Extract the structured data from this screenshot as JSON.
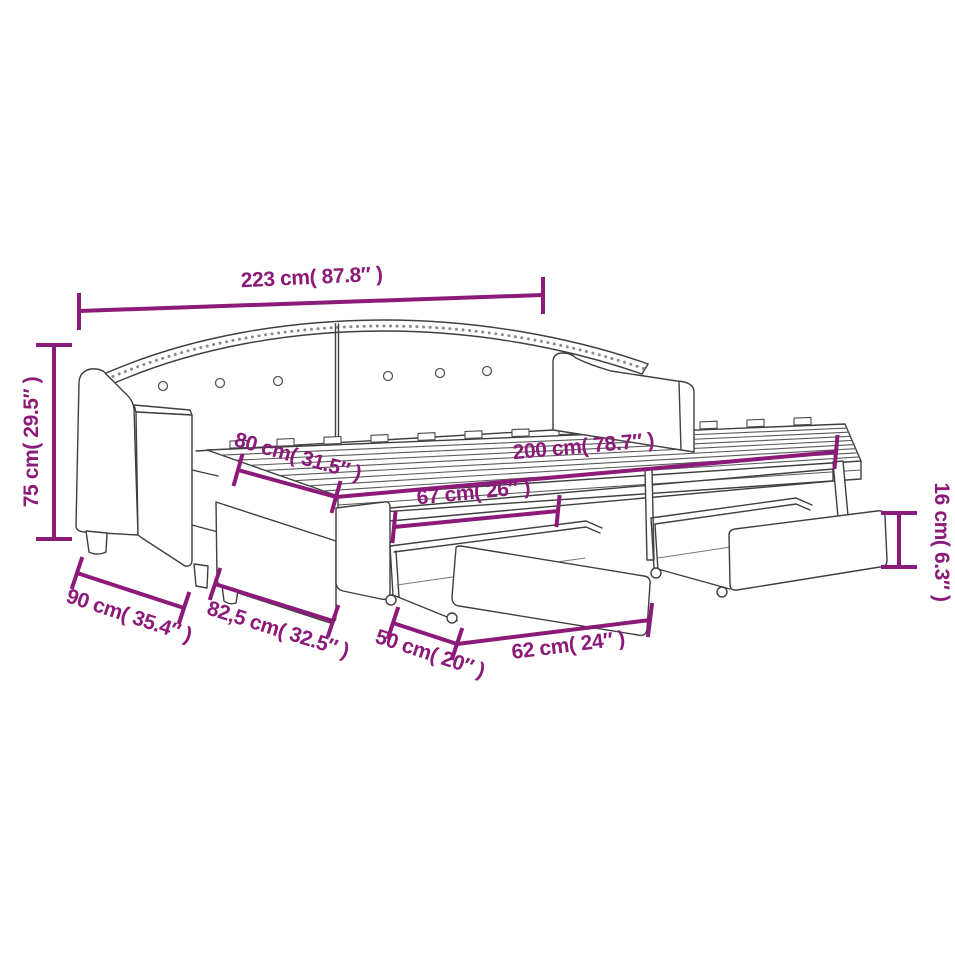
{
  "diagram": {
    "subject": "daybed-with-trundle-and-drawers dimension drawing",
    "background_color": "#ffffff",
    "line_color": "#3f3f3f",
    "dimension_color": "#8C1A78"
  },
  "dimensions": [
    {
      "id": "overall-width",
      "label": "223 cm( 87.8″ )",
      "cm": "223",
      "inches": "87.8"
    },
    {
      "id": "overall-height",
      "label": "75 cm( 29.5″ )",
      "cm": "75",
      "inches": "29.5"
    },
    {
      "id": "bed-depth",
      "label": "80 cm( 31.5″ )",
      "cm": "80",
      "inches": "31.5"
    },
    {
      "id": "bed-length",
      "label": "200 cm( 78.7″ )",
      "cm": "200",
      "inches": "78.7"
    },
    {
      "id": "drawer-depth",
      "label": "67 cm( 26″ )",
      "cm": "67",
      "inches": "26"
    },
    {
      "id": "drawer-height",
      "label": "16 cm( 6.3″ )",
      "cm": "16",
      "inches": "6.3"
    },
    {
      "id": "armrest-depth",
      "label": "90 cm( 35.4″ )",
      "cm": "90",
      "inches": "35.4"
    },
    {
      "id": "trundle-depth",
      "label": "82,5 cm( 32.5″ )",
      "cm": "82,5",
      "inches": "32.5"
    },
    {
      "id": "wheel-gap",
      "label": "50 cm( 20″ )",
      "cm": "50",
      "inches": "20"
    },
    {
      "id": "drawer-length",
      "label": "62 cm( 24″ )",
      "cm": "62",
      "inches": "24"
    }
  ]
}
